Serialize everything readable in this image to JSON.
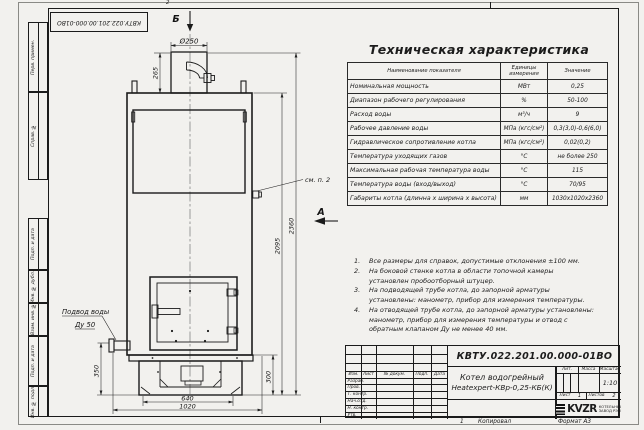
{
  "meta": {
    "top_zone_mark": "2",
    "bottom_zone_mark": "1",
    "copied_label": "Копировал",
    "format_label": "Формат А3"
  },
  "colors": {
    "ink": "#1c1c1c",
    "paper": "#f2f1ee"
  },
  "frame": {
    "rotated_doc_number": "КВТУ.022.201.00.000-01ВО",
    "left_top_labels": [
      "Перв. примен.",
      "Справ. №"
    ],
    "left_bottom_labels": [
      "Подп. и дата",
      "Инв. № дубл.",
      "Взам. инв. №",
      "Подп. и дата",
      "Инв. № подл."
    ]
  },
  "drawing": {
    "section_label_top": "Б",
    "view_label_side": "А",
    "callout_note2": "см. п. 2",
    "water_inlet_label_line1": "Подвод воды",
    "water_inlet_label_line2": "Ду 50",
    "dim_chimney_diameter": "Ø250",
    "dim_chimney_height": "265",
    "dim_body_height": "2095",
    "dim_total_height": "2360",
    "dim_base_height": "300",
    "dim_inlet_height": "350",
    "dim_feet_width": "640",
    "dim_base_width": "1020"
  },
  "spec_table": {
    "title": "Техническая характеристика",
    "headers": [
      "Наименование показателя",
      "Единицы измерения",
      "Значение"
    ],
    "rows": [
      [
        "Номинальная мощность",
        "МВт",
        "0,25"
      ],
      [
        "Диапазон рабочего регулирования",
        "%",
        "50-100"
      ],
      [
        "Расход воды",
        "м³/ч",
        "9"
      ],
      [
        "Рабочее давление воды",
        "МПа (кгс/см²)",
        "0,3(3,0)-0,6(6,0)"
      ],
      [
        "Гидравлическое сопротивление котла",
        "МПа (кгс/см²)",
        "0,02(0,2)"
      ],
      [
        "Температура уходящих газов",
        "°С",
        "не более 250"
      ],
      [
        "Максимальная рабочая температура воды",
        "°С",
        "115"
      ],
      [
        "Температура воды (вход/выход)",
        "°С",
        "70/95"
      ],
      [
        "Габариты котла (длинна х ширина х высота)",
        "мм",
        "1030х1020х2360"
      ]
    ]
  },
  "notes": [
    {
      "num": "1.",
      "text": "Все размеры для справок, допустимые отклонения ±100 мм."
    },
    {
      "num": "2.",
      "text": "На боковой стенке котла в области топочной камеры установлен пробоотборный штуцер."
    },
    {
      "num": "3.",
      "text": "На подводящей трубе котла, до запорной арматуры установлены: манометр, прибор для измерения температуры."
    },
    {
      "num": "4.",
      "text": "На отводящей трубе котла, до запорной арматуры установлены: манометр, прибор для измерения температуры и отвод с обратным клапаном Ду не менее 40 мм."
    }
  ],
  "title_block": {
    "doc_number": "КВТУ.022.201.00.000-01ВО",
    "product_name_line1": "Котел водогрейный",
    "product_name_line2": "Heatexpert-КВр-0,25-КБ(К)",
    "rev_headers": [
      "Изм.",
      "Лист",
      "№ докум.",
      "Подп.",
      "Дата"
    ],
    "sign_rows": [
      "Разраб.",
      "Пров.",
      "Т. контр.",
      "Нач.отд.",
      "Н. контр.",
      "Утв."
    ],
    "lit_label": "Лит.",
    "mass_label": "Масса",
    "scale_label": "Масштаб",
    "scale_value": "1:10",
    "sheet_label": "Лист",
    "sheet_value": "1",
    "sheets_label": "Листов",
    "sheets_value": "2",
    "company_logo_text": "KVZR",
    "company_line1": "КОТЕЛЬНЫЙ",
    "company_line2": "ЗАВОД РЭП"
  }
}
